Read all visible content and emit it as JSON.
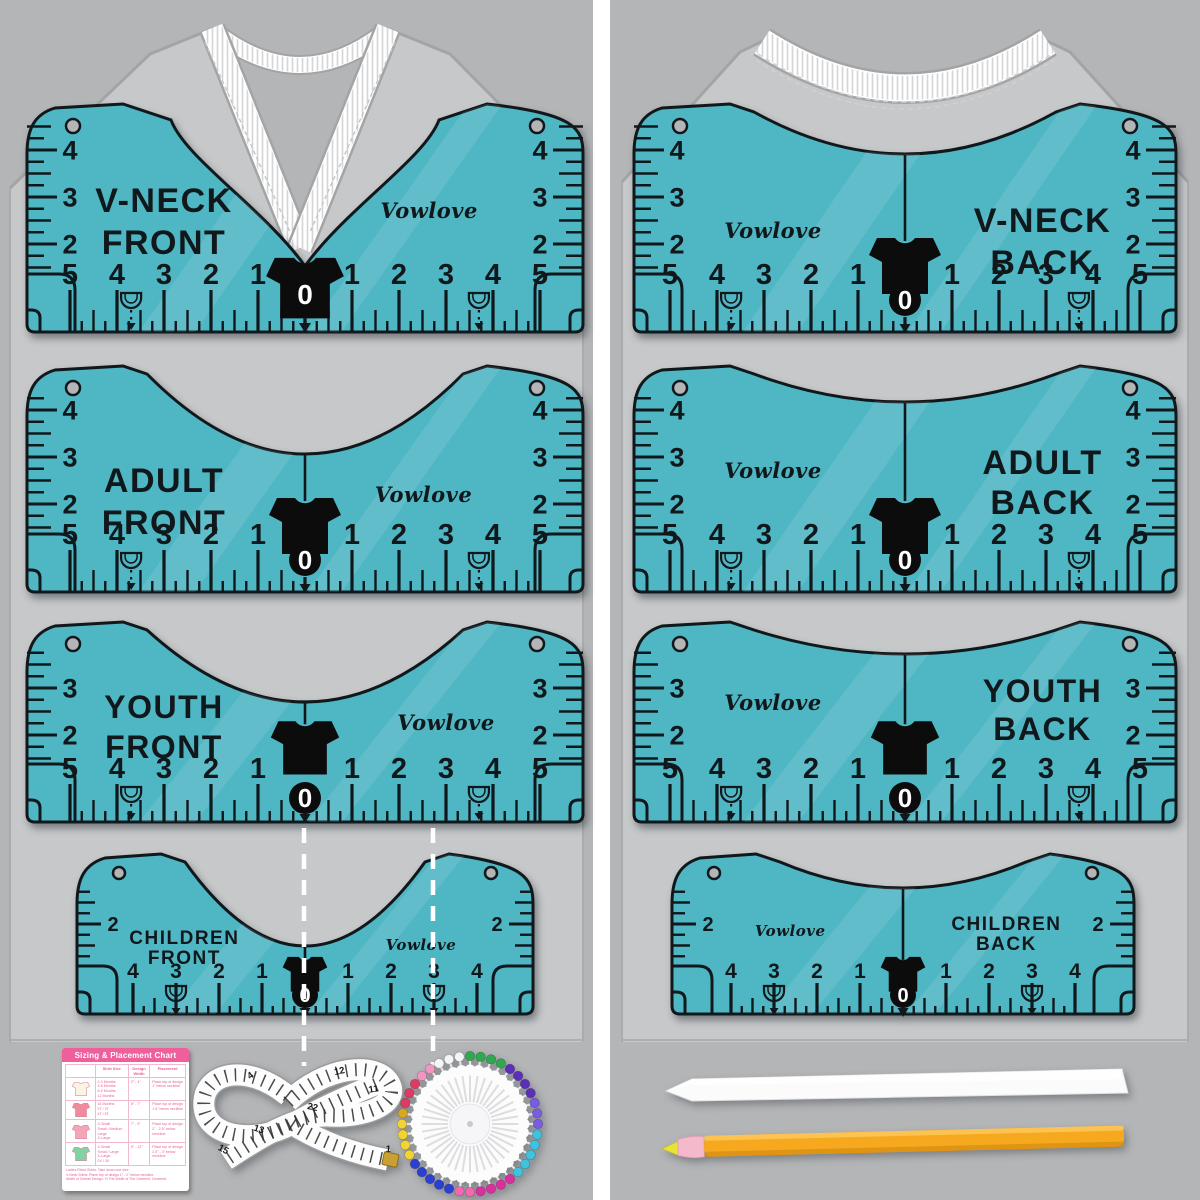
{
  "product": {
    "brand": "Vowlove"
  },
  "colors": {
    "ruler_teal": "#4fb6c3",
    "ink": "#11181c",
    "panel_bg": "#b4b5b7",
    "shirt_gray": "#c7c8ca",
    "shirt_outline": "#a3a4a6",
    "gutter_white": "#ffffff",
    "guide_white": "#ffffff",
    "card_pink": "#ee5f9b",
    "card_text_pink": "#e75f98",
    "pencil_yellow": "#f6a81f",
    "pencil_tip_pink": "#f4b9ca",
    "pencil_lead_yellow": "#e8e436",
    "tape_gold": "#c9a132"
  },
  "rulers": [
    {
      "id": "v-neck-front",
      "title": [
        "V-NECK",
        "FRONT"
      ],
      "brand": "Vowlove",
      "side_scale": [
        4,
        3,
        2
      ],
      "h_scale": [
        5,
        4,
        3,
        2,
        1,
        0,
        1,
        2,
        3,
        4,
        5
      ]
    },
    {
      "id": "v-neck-back",
      "title": [
        "V-NECK",
        "BACK"
      ],
      "brand": "Vowlove",
      "side_scale": [
        4,
        3,
        2
      ],
      "h_scale": [
        5,
        4,
        3,
        2,
        1,
        0,
        1,
        2,
        3,
        4,
        5
      ]
    },
    {
      "id": "adult-front",
      "title": [
        "ADULT",
        "FRONT"
      ],
      "brand": "Vowlove",
      "side_scale": [
        4,
        3,
        2
      ],
      "h_scale": [
        5,
        4,
        3,
        2,
        1,
        0,
        1,
        2,
        3,
        4,
        5
      ]
    },
    {
      "id": "adult-back",
      "title": [
        "ADULT",
        "BACK"
      ],
      "brand": "Vowlove",
      "side_scale": [
        4,
        3,
        2
      ],
      "h_scale": [
        5,
        4,
        3,
        2,
        1,
        0,
        1,
        2,
        3,
        4,
        5
      ]
    },
    {
      "id": "youth-front",
      "title": [
        "YOUTH",
        "FRONT"
      ],
      "brand": "Vowlove",
      "side_scale": [
        3,
        2
      ],
      "h_scale": [
        5,
        4,
        3,
        2,
        1,
        0,
        1,
        2,
        3,
        4,
        5
      ]
    },
    {
      "id": "youth-back",
      "title": [
        "YOUTH",
        "BACK"
      ],
      "brand": "Vowlove",
      "side_scale": [
        3,
        2
      ],
      "h_scale": [
        5,
        4,
        3,
        2,
        1,
        0,
        1,
        2,
        3,
        4,
        5
      ]
    },
    {
      "id": "children-front",
      "title": [
        "CHILDREN",
        "FRONT"
      ],
      "brand": "Vowlove",
      "side_scale": [
        2
      ],
      "h_scale": [
        4,
        3,
        2,
        1,
        0,
        1,
        2,
        3,
        4
      ]
    },
    {
      "id": "children-back",
      "title": [
        "CHILDREN",
        "BACK"
      ],
      "brand": "Vowlove",
      "side_scale": [
        2
      ],
      "h_scale": [
        4,
        3,
        2,
        1,
        0,
        1,
        2,
        3,
        4
      ]
    }
  ],
  "card": {
    "title": "Sizing & Placement Chart",
    "headers": [
      "Shirt Size",
      "Design Width",
      "Placement"
    ],
    "rows": [
      {
        "shirt_color": "#fbf4e4",
        "sizes": [
          "0-3 Months",
          "3-6 Months",
          "6-9 Months",
          "12 Months"
        ],
        "design_width": "3\" - 4\"",
        "placement": "Place top of design 1\" below neckline"
      },
      {
        "shirt_color": "#f08a9e",
        "sizes": [
          "18 Months",
          "2T / 3T",
          "4T / 5T"
        ],
        "design_width": "5\" - 7\"",
        "placement": "Place top of design 1.5\" below neckline"
      },
      {
        "shirt_color": "#f4a5b8",
        "sizes": [
          "X-Small",
          "Small / Medium",
          "Large",
          "X-Large"
        ],
        "design_width": "7\" - 9\"",
        "placement": "Place top of design 2\" - 2.5\" below neckline"
      },
      {
        "shirt_color": "#82d3a4",
        "sizes": [
          "X-Small",
          "Small / Large",
          "X-Large",
          "2X / 3X"
        ],
        "design_width": "9\" - 12\"",
        "placement": "Place top of design 2.5\" - 3\" below neckline"
      }
    ],
    "footnotes": [
      "Ladies Fitted Shirts: Take down one size.",
      "V-Neck Shirts: Place top of design 1\" - 2\" below neckline.",
      "Width of Overall Design: ½ The Width of The Garment, Centered."
    ]
  },
  "tape_measure": {
    "visible_numbers": [
      "4",
      "12",
      "11",
      "22",
      "13",
      "15",
      "1"
    ]
  },
  "pin_wheel": {
    "pin_colors": [
      "#2fa84f",
      "#2fa84f",
      "#2fa84f",
      "#2fa84f",
      "#5b2fb8",
      "#5b2fb8",
      "#5b2fb8",
      "#5b2fb8",
      "#7a5ce0",
      "#7a5ce0",
      "#7a5ce0",
      "#3fc1e0",
      "#3fc1e0",
      "#3fc1e0",
      "#3fc1e0",
      "#3fc1e0",
      "#d9309f",
      "#d9309f",
      "#d9309f",
      "#d9309f",
      "#f468ae",
      "#f468ae",
      "#2b3fd0",
      "#2b3fd0",
      "#2b3fd0",
      "#2b3fd0",
      "#2b3fd0",
      "#f2d430",
      "#f2d430",
      "#f2d430",
      "#f2d430",
      "#d9a620",
      "#e03a63",
      "#e03a63",
      "#e03a63",
      "#f395c0",
      "#f395c0",
      "#f4f5f7",
      "#f4f5f7",
      "#f4f5f7"
    ]
  }
}
